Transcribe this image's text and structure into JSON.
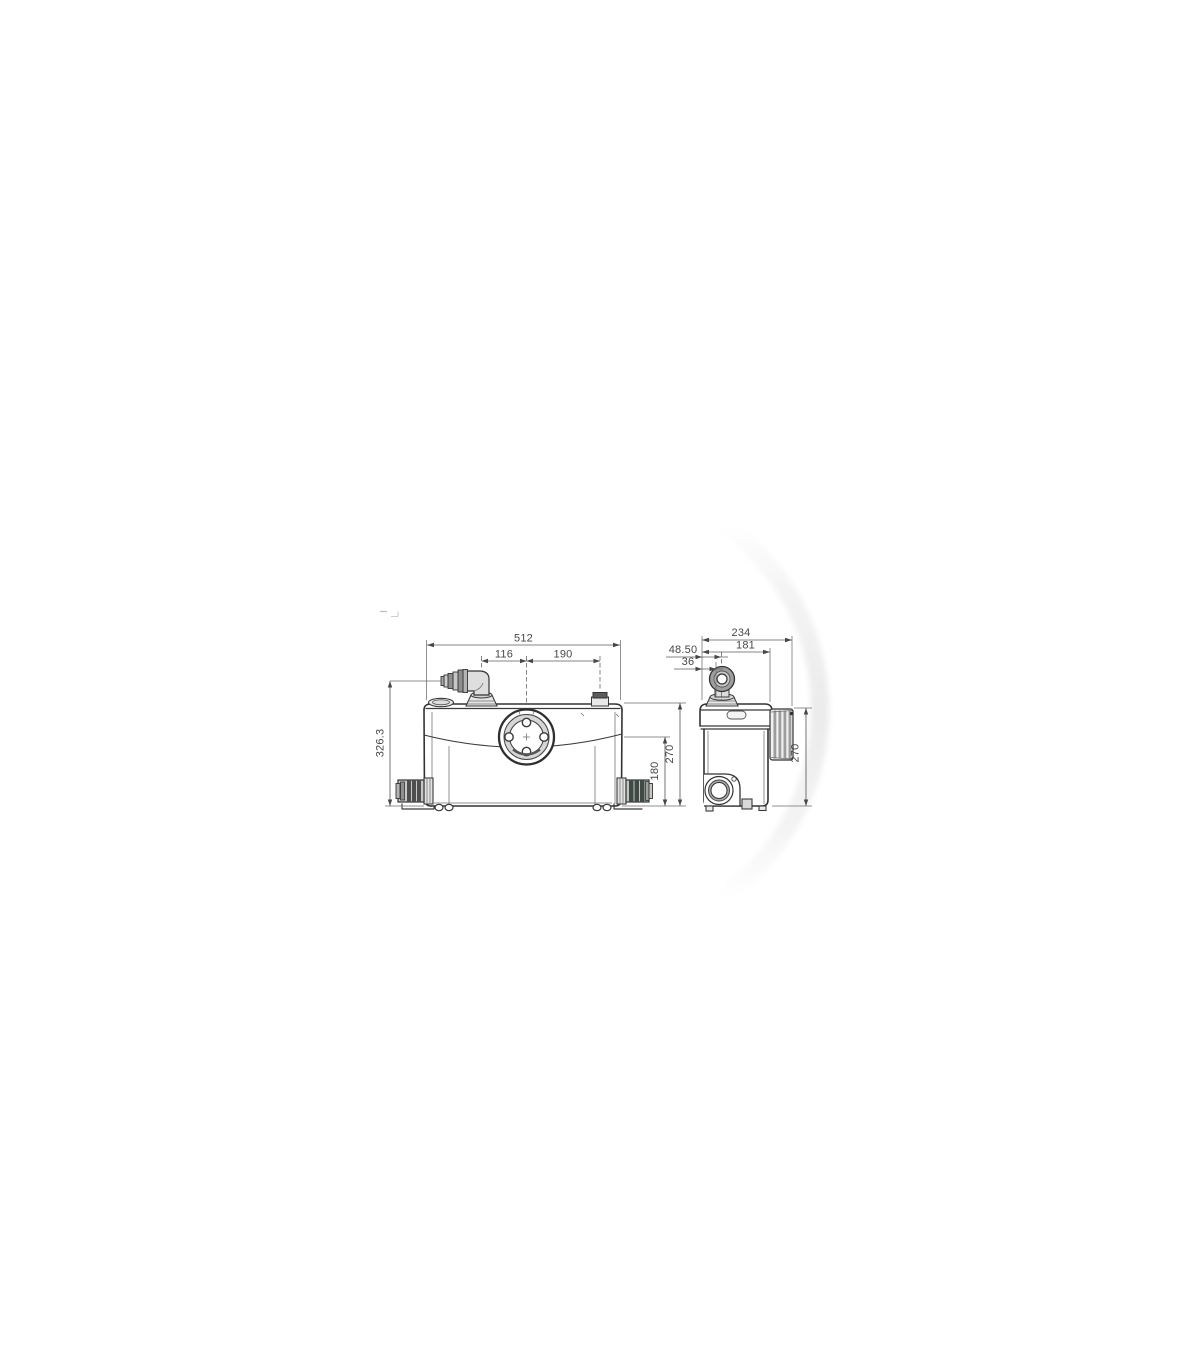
{
  "page": {
    "background": "#ffffff"
  },
  "diagram": {
    "type": "technical-dimension-drawing",
    "subject": "macerator-pump-two-views",
    "colors": {
      "line": "#3a3a3a",
      "dim_text": "#474747",
      "swoosh": "#ebebeb"
    },
    "front_view": {
      "dims": {
        "overall_width": "512",
        "outlet_to_center": "116",
        "center_to_vent": "190",
        "overall_height": "326.3",
        "inlet_height": "180",
        "body_height": "270"
      }
    },
    "side_view": {
      "dims": {
        "overall_depth": "234",
        "body_depth": "181",
        "outlet_back_offset": "48.50",
        "outlet_center_offset": "36",
        "body_height": "270"
      }
    }
  }
}
